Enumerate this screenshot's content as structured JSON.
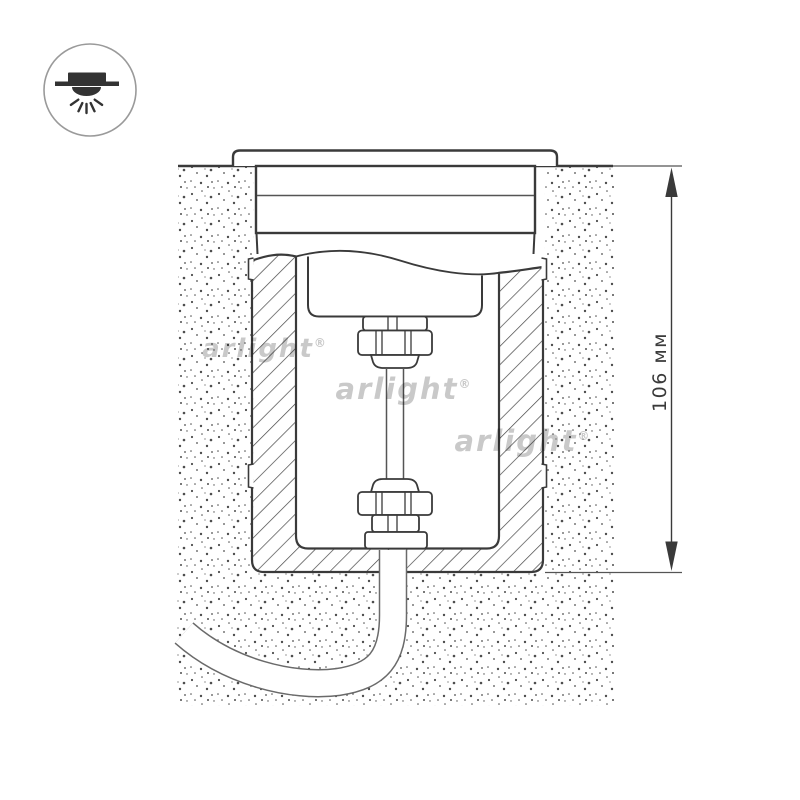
{
  "badge": {
    "icon": "recessed-downlight-icon"
  },
  "dimension": {
    "label": "106 мм"
  },
  "watermark": {
    "text": "arlight",
    "symbol": "®"
  },
  "colors": {
    "background": "#ffffff",
    "line": "#3a3a3a",
    "line_light": "#555555",
    "hatch": "#454545",
    "stipple": "#2e2e2e",
    "watermark": "#c5c5c5",
    "icon": "#333333",
    "cable_outline": "#6a6a6a"
  }
}
